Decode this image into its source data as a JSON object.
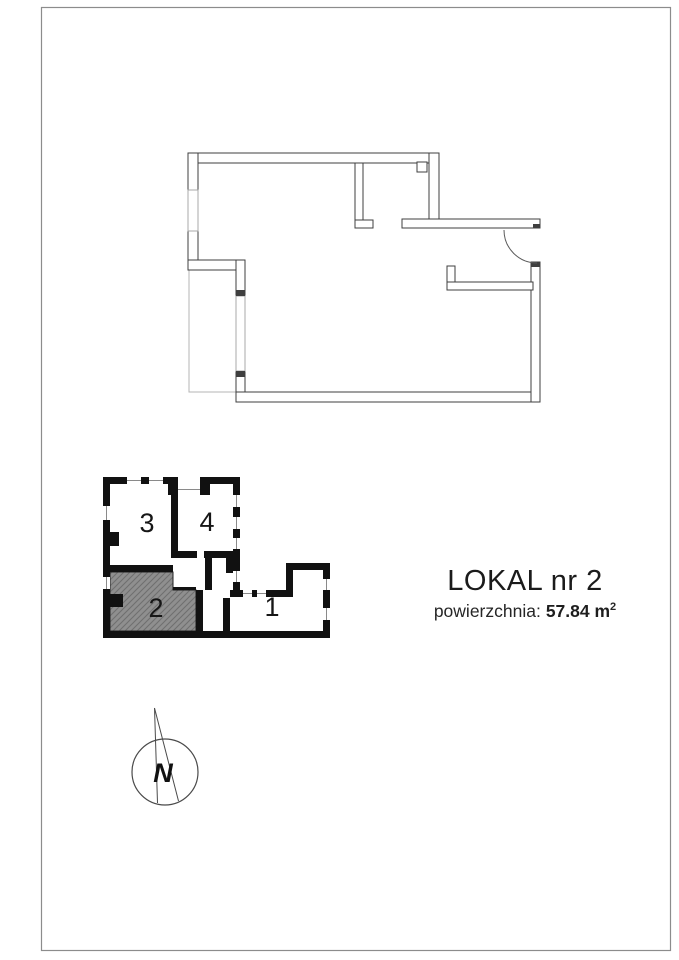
{
  "page": {
    "background": "#ffffff",
    "border_color": "#8c8c8c"
  },
  "title_block": {
    "title": "LOKAL nr 2",
    "area_label": "powierzchnia:",
    "area_value": "57.84 m",
    "area_exponent": "2"
  },
  "main_plan": {
    "wall_color": "#3f3f3f",
    "window_color": "#a8a8a8",
    "terrace_color": "#b5b5b5"
  },
  "key_plan": {
    "wall_color": "#111111",
    "label_color": "#161616",
    "highlight_fill": "#8f8f8f",
    "hatch_line_color": "#6f6f6f",
    "window_line_color": "#8a8a8a",
    "units": [
      {
        "label": "3",
        "highlighted": false
      },
      {
        "label": "4",
        "highlighted": false
      },
      {
        "label": "2",
        "highlighted": true
      },
      {
        "label": "1",
        "highlighted": false
      }
    ]
  },
  "compass": {
    "label": "N",
    "line_color": "#4a4a4a"
  }
}
